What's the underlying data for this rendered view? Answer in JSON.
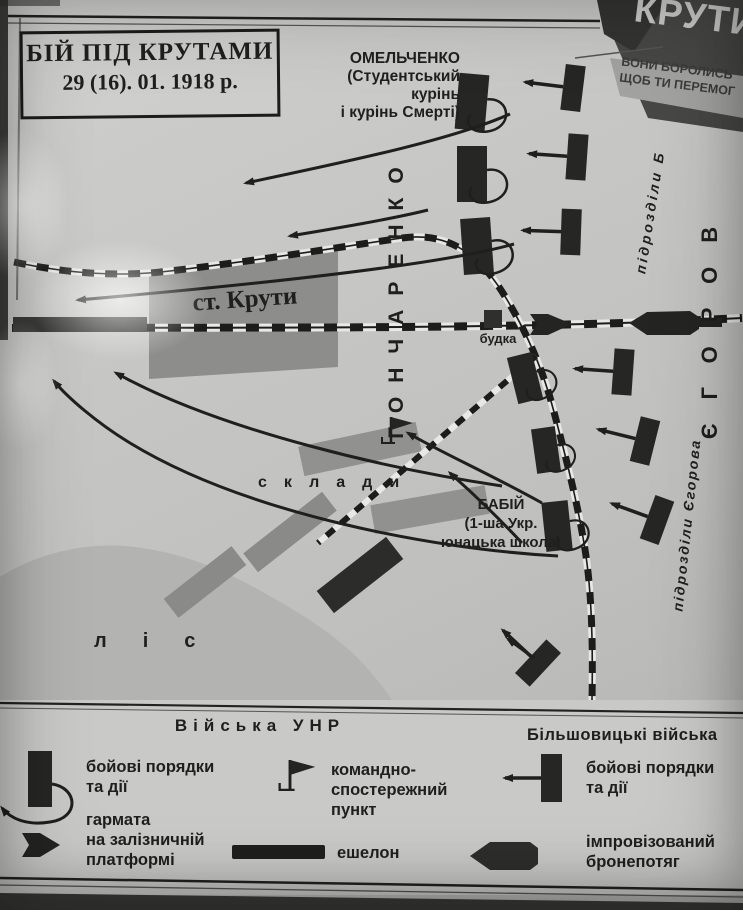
{
  "title_box": {
    "line1": "БІЙ ПІД КРУТАМИ",
    "line2": "29 (16). 01. 1918 р."
  },
  "poster": {
    "title": "КРУТИ",
    "subtitle_line1": "ВОНИ БОРОЛИСЬ",
    "subtitle_line2": "ЩОБ ТИ ПЕРЕМОГ"
  },
  "map": {
    "station_label": "ст. Крути",
    "budka_label": "будка",
    "sklady_label": "склади",
    "lis_label": "ліс",
    "honcharenko_label": "ГОНЧАРЕНКО",
    "yehorov_label": "ЄГОРОВ",
    "pidrozdily_b_label": "підрозділи Б",
    "pidrozdily_yehorova_label": "підрозділи Єгорова",
    "omelchenko": {
      "line1": "ОМЕЛЬЧЕНКО",
      "line2": "(Студентський",
      "line3": "курінь",
      "line4": "і курінь Смерті)"
    },
    "babiy": {
      "line1": "БАБІЙ",
      "line2": "(1-ша Укр.",
      "line3": "юнацька школа)"
    }
  },
  "legend": {
    "unr_header": "Війська УНР",
    "bolshevik_header": "Більшовицькі війська",
    "unr_combat": {
      "line1": "бойові порядки",
      "line2": "та дії"
    },
    "cannon": {
      "line1": "гармата",
      "line2": "на залізничній",
      "line3": "платформі"
    },
    "command_post": {
      "line1": "командно-",
      "line2": "спостережний",
      "line3": "пункт"
    },
    "echelon_label": "ешелон",
    "bolshevik_combat": {
      "line1": "бойові порядки",
      "line2": "та дії"
    },
    "armored_train": {
      "line1": "імпровізований",
      "line2": "бронепотяг"
    }
  },
  "symbols": {
    "unr_unit": "black-bar-with-loop-arrow",
    "bolshevik_unit": "black-bar-with-left-arrow",
    "command_post": "flag-on-pole",
    "echelon": "thick-black-bar",
    "cannon_platform": "right-pointing-arrow-block",
    "armored_train": "left-pointing-hexagon",
    "railway": "black-white-dashed-line"
  },
  "colors": {
    "paper": "#c3c3c1",
    "ink": "#1f1f1d",
    "station_fill": "#8d8d8b",
    "forest_fill": "#b3b3b1",
    "warehouse_fill": "#919190",
    "poster_dark": "#474745",
    "poster_band": "#a2a2a0",
    "legend_paper": "#c9c9c7"
  }
}
